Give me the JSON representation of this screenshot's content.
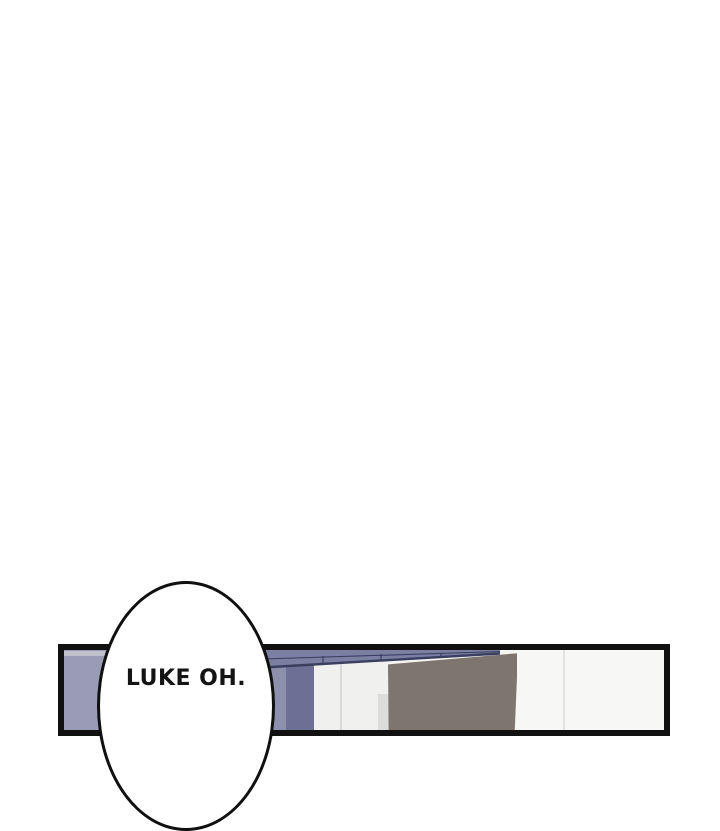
{
  "page": {
    "background": "#ffffff"
  },
  "panel": {
    "border_color": "#111111",
    "scene": {
      "wall_color": "#9a9cb5",
      "wall_strip_color": "#c0c1cc",
      "wall_column_light_color": "#8c90ad",
      "wall_column_dark_color": "#6b7094",
      "highlight_tile_color": "#e9ebef",
      "beam_fill_color": "#7b80a3",
      "beam_edge_color": "#3a3f5e",
      "cabinet_panels_white": "#f0f0ef",
      "panel_seam_color": "#d9d9d9",
      "cabinet_brown": "#7e766e",
      "right_wall_white": "#f7f7f6",
      "right_seam_color": "#e2e2e2",
      "floor_color": "#dcdcda"
    }
  },
  "speech_bubble": {
    "text": "LUKE OH.",
    "fill": "#ffffff",
    "outline_color": "#101010"
  }
}
